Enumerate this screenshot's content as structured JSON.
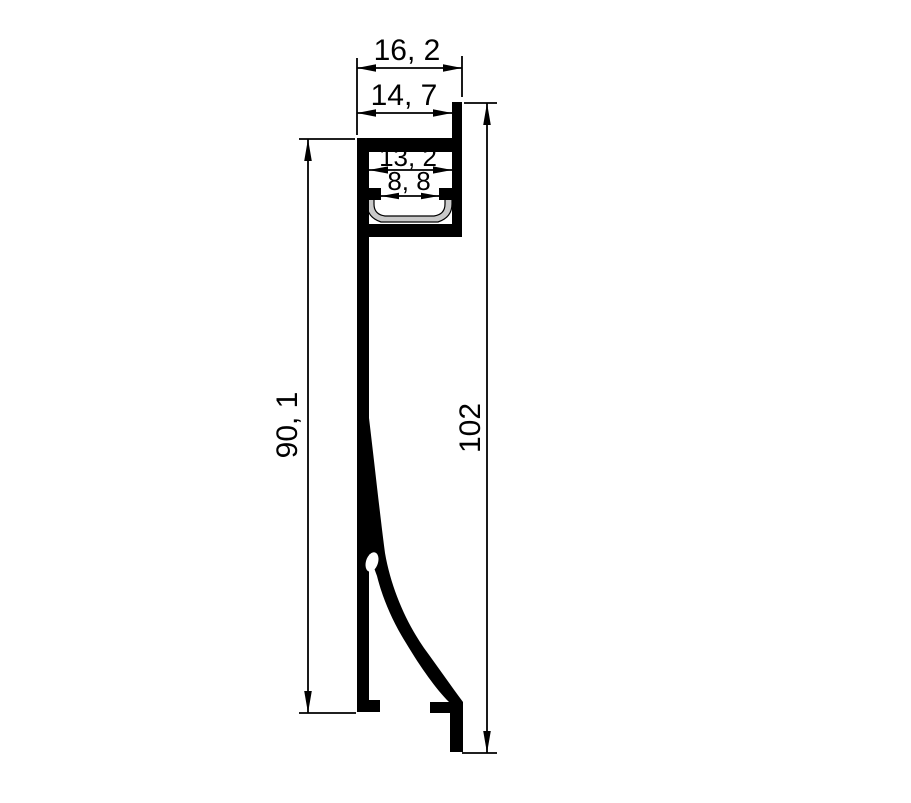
{
  "drawing": {
    "dimensions": {
      "overall_width": "16, 2",
      "top_width": "14, 7",
      "channel_width": "13, 2",
      "opening_width": "8, 8",
      "back_height": "90, 1",
      "overall_height": "102"
    },
    "colors": {
      "line": "#000000",
      "background": "#ffffff",
      "diffuser": "#c9c9c9"
    }
  }
}
